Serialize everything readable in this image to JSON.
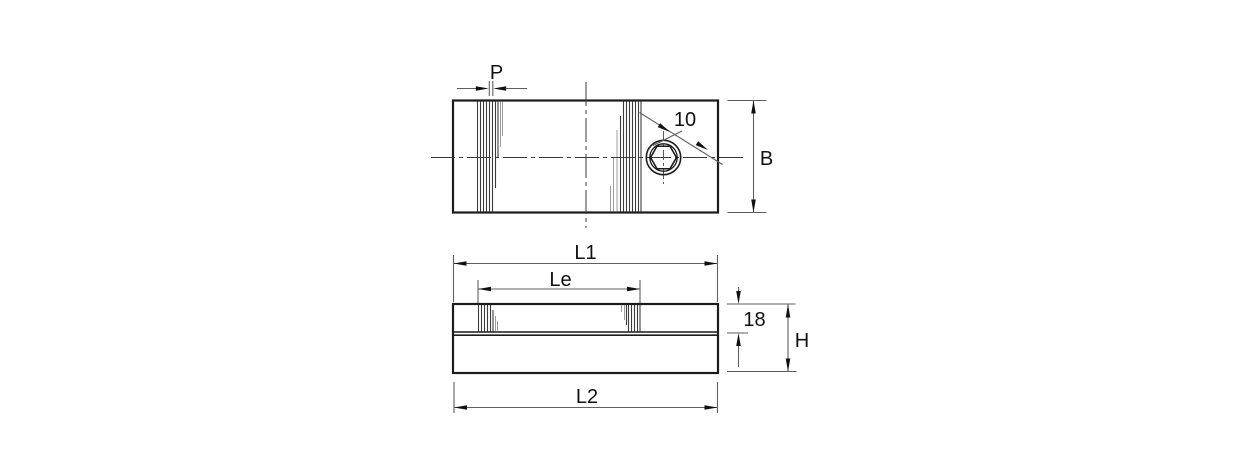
{
  "drawing": {
    "kind": "technical-drawing-two-views",
    "views": {
      "top": "top-view",
      "front": "front-view"
    },
    "labels": {
      "pitch": "P",
      "hole_diameter": "10",
      "width": "B",
      "length_l1": "L1",
      "length_le": "Le",
      "scale_height": "18",
      "total_height": "H",
      "length_l2": "L2"
    },
    "colors": {
      "background": "#ffffff",
      "outline": "#1c1c1c",
      "dimension": "#5f5f5f",
      "hatch_dark": "#3c3c3c",
      "hatch_light": "#9c9c9c",
      "text": "#111111"
    }
  }
}
